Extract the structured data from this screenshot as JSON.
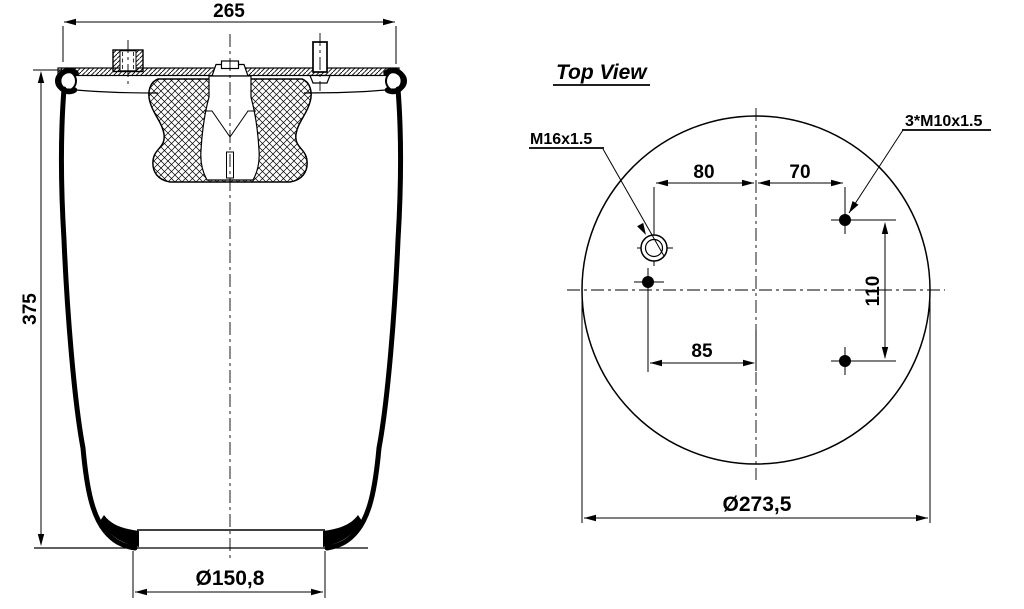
{
  "colors": {
    "line": "#000000",
    "background": "#ffffff"
  },
  "side_view": {
    "width": "265",
    "height": "375",
    "base_diameter": "Ø150,8"
  },
  "top_view": {
    "title": "Top View",
    "fitting_label": "M16x1.5",
    "bolt_pattern_label": "3*M10x1.5",
    "dim_fitting_offset_x": "80",
    "dim_bolt_offset_x": "70",
    "dim_bolt_spacing_y": "110",
    "dim_lower_bolt_offset_x": "85",
    "plate_diameter": "Ø273,5"
  }
}
